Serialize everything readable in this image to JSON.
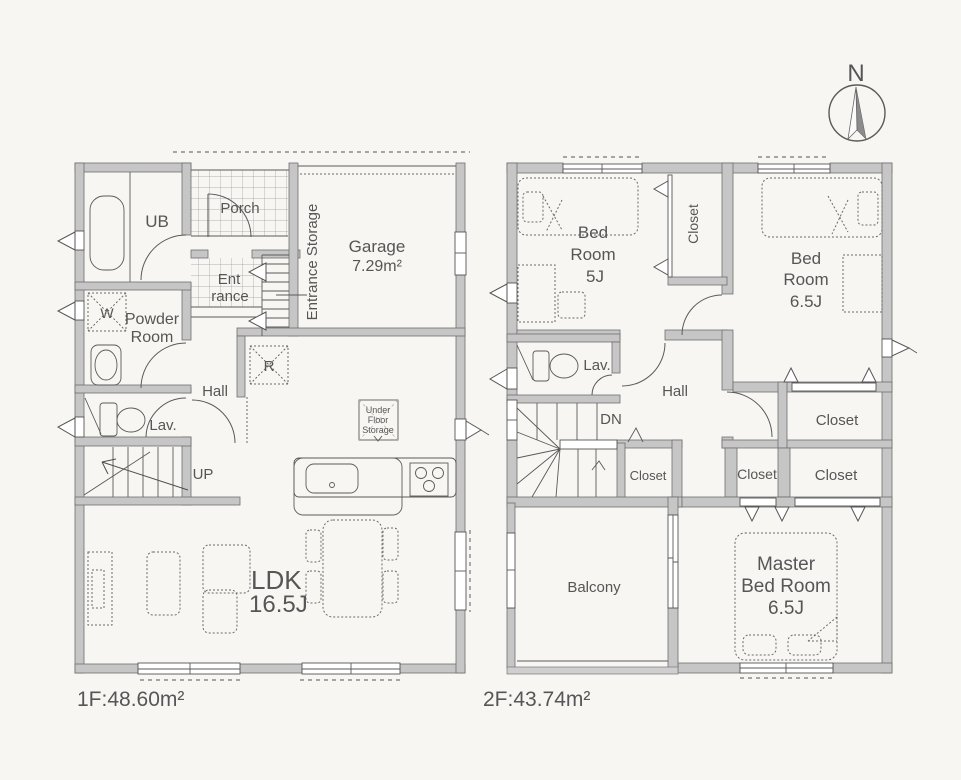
{
  "compass": {
    "north": "N"
  },
  "floor1": {
    "area": "1F:48.60m²",
    "ub": "UB",
    "porch": "Porch",
    "ent1": "Ent",
    "ent2": "rance",
    "storage": "Entrance Storage",
    "garage_name": "Garage",
    "garage_area": "7.29m²",
    "washer": "W",
    "powder1": "Powder",
    "powder2": "Room",
    "hall": "Hall",
    "lav": "Lav.",
    "up": "UP",
    "fridge": "R",
    "ufs1": "Under",
    "ufs2": "Floor",
    "ufs3": "Storage",
    "ldk": "LDK",
    "ldk_size": "16.5J"
  },
  "floor2": {
    "area": "2F:43.74m²",
    "bed5_1": "Bed",
    "bed5_2": "Room",
    "bed5_3": "5J",
    "closet_a": "Closet",
    "bed65_1": "Bed",
    "bed65_2": "Room",
    "bed65_3": "6.5J",
    "lav": "Lav.",
    "hall": "Hall",
    "dn": "DN",
    "closet_b": "Closet",
    "closet_c": "Closet",
    "closet_d": "Closet",
    "closet_e": "Closet",
    "balcony": "Balcony",
    "master1": "Master",
    "master2": "Bed Room",
    "master3": "6.5J"
  },
  "colors": {
    "wall": "#c6c6c6",
    "line": "#4e4e4e",
    "text": "#565656",
    "bg": "#f7f6f3"
  }
}
